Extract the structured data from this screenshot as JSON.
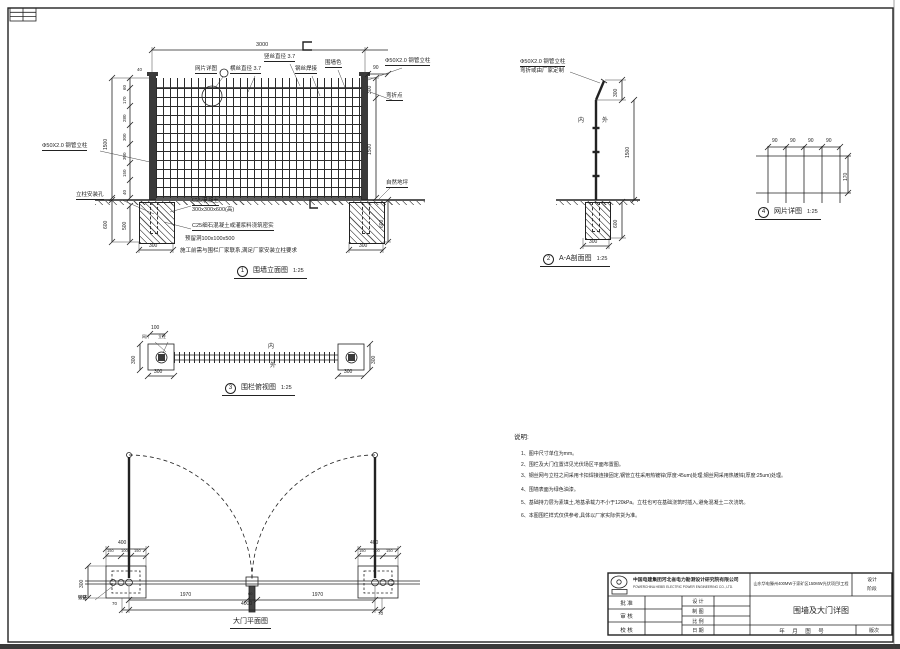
{
  "elevation": {
    "callout": "1",
    "title": "围墙立面图",
    "scale": "1:25",
    "labels": {
      "mesh_detail": "网片详图",
      "horiz_wire": "横丝直径 3.7",
      "vert_wire": "竖丝直径 3.7",
      "weld": "钢丝焊接",
      "paint": "围墙色",
      "post_right": "Φ50X2.0 钢管立柱",
      "bend_point": "弯折点",
      "ground": "自然地坪",
      "post_left": "Φ50X2.0 钢管立柱",
      "install_hole": "立柱安装孔",
      "concrete": "C25混凝土",
      "concrete_size": "300x300x600(高)",
      "grout": "C25细石混凝土或灌浆料浇筑密实",
      "reserved_hole": "预留洞100x100x500",
      "install_note": "施工前需与围栏厂家联系,满足厂家安装立柱要求"
    },
    "dims": {
      "width": "3000",
      "top_offset_left": "40",
      "top_offset_right": "90",
      "chain": [
        "60",
        "170",
        "280",
        "300",
        "300",
        "150",
        "40"
      ],
      "height_left": "1500",
      "height_right": "1500",
      "bend_top": "300",
      "depth_left": "600",
      "embed": "500",
      "found_width_left": "300",
      "depth_right": "600",
      "found_width_right": "300"
    }
  },
  "section": {
    "callout": "2",
    "title": "A-A剖面图",
    "scale": "1:25",
    "labels": {
      "post": "Φ50X2.0 钢管立柱",
      "bend": "弯折或由厂家定制",
      "inner": "内",
      "outer": "外"
    },
    "dims": {
      "bend_top": "300",
      "height": "1500",
      "depth": "600",
      "found_width": "300"
    }
  },
  "mesh": {
    "callout": "4",
    "title": "网片详图",
    "scale": "1:25",
    "dims": {
      "w": [
        "90",
        "90",
        "90",
        "90"
      ],
      "h": "170"
    }
  },
  "topview": {
    "callout": "3",
    "title": "围栏俯视图",
    "scale": "1:25",
    "labels": {
      "inner": "内",
      "outer": "外",
      "mesh": "网片",
      "post": "立柱"
    },
    "dims": {
      "top": "100",
      "side_left": "300",
      "bottom_left": "300",
      "side_right": "300",
      "bottom_right": "300"
    }
  },
  "gate": {
    "title": "大门平面图",
    "labels": {
      "hinge": "铰链"
    },
    "dims": {
      "post_width_left": "400",
      "post_chain_left": [
        "150",
        "100",
        "150"
      ],
      "post_width_right": "400",
      "post_chain_right": [
        "150",
        "100",
        "150"
      ],
      "leaf_left": "1970",
      "center": "60",
      "leaf_right": "1970",
      "total": "4000",
      "edge_left": "70",
      "edge_right": "70",
      "side": "300"
    }
  },
  "notes": {
    "heading": "说明:",
    "items": [
      "1、图中尺寸单位为mm。",
      "2、围栏及大门位置详见光伏场区平面布置图。",
      "3、钢丝网与立柱之间采用卡扣焊接连接固定,钢管立柱采用热镀锌(厚度:45um)处理;钢丝网采用热镀锌(厚度:25um)处理。",
      "4、围墙表面为绿色油漆。",
      "5、基础持力层为素填土,地基承载力不小于120kPa。立柱也可在基础浇筑时插入,避免混凝土二次浇筑。",
      "6、本图围栏样式仅供参考,具体以厂家实际供货为准。"
    ]
  },
  "titleblock": {
    "company_cn": "中国电建集团河北省电力勘测设计研究院有限公司",
    "company_en": "POWERCHINA HEBEI ELECTRIC POWER ENGINEERING CO., LTD.",
    "project": "山东华电滕州400MW于家矿区150MW光伏项目Ⅰ工程",
    "stage_line1": "设计",
    "stage_line2": "阶段",
    "drawing_title": "围墙及大门详图",
    "fields": {
      "approve": "批 准",
      "review": "审 核",
      "check": "校 核",
      "design": "设 计",
      "draft": "制 图",
      "ratio": "比 例",
      "date": "日 期",
      "date_no": "年 月 图 号",
      "version": "版次"
    }
  }
}
